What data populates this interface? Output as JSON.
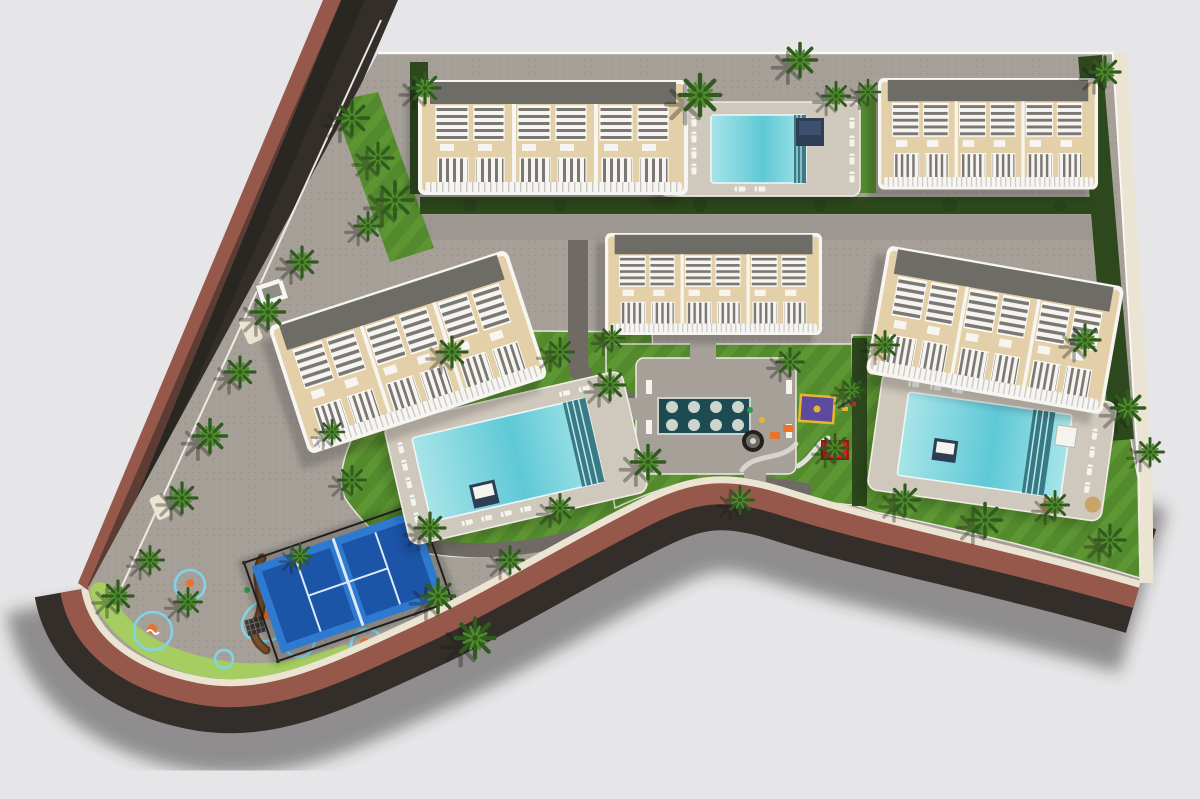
{
  "scene": {
    "kind": "aerial-site-plan-3d-render",
    "description": "Top-down architectural rendering of a residential resort complex with five apartment blocks, three swimming pools, a reflecting pond plaza, playground, splash pad, padel court, palm trees, perimeter road and paths",
    "background_label": "empty light-gray ground"
  },
  "colors": {
    "background": "#e6e6e8",
    "asphalt": "#332e29",
    "asphalt_shadow": "#262320",
    "brick": "#96584b",
    "sidewalk_cream": "#ece4d2",
    "paving": "#a6a099",
    "paving_dot": "#8a847c",
    "path_dark": "#6f6a64",
    "lawn": "#538a2d",
    "lawn_stripe": "#6da53c",
    "lawn_light": "#a5cd62",
    "hedge": "#2c481c",
    "palm_green": "#2f5c1e",
    "palm_light": "#4f8a2b",
    "roof_beige": "#e4d0a8",
    "roof_gray": "#6e6c67",
    "building_white": "#f6f5f2",
    "stripe_gray": "#7b7873",
    "pool_turquoise": "#5ec9d6",
    "pool_light": "#a7e4e8",
    "pool_steps": "#2e6f7a",
    "pond_teal": "#1e4a52",
    "pond_disc": "#cdd6cd",
    "deck": "#cfc8bc",
    "padel_blue": "#2e7ad0",
    "padel_dark": "#1c55a8",
    "padel_line": "#dce9f8",
    "cage_black": "#1f1f1f",
    "splash_blue": "#2f86c8",
    "splash_rim": "#7fd4e8",
    "accent_orange": "#e8742c",
    "accent_red": "#c6281e",
    "accent_yellow": "#e8b62a",
    "accent_purple": "#5b4a9e",
    "daybed_navy": "#2e3e55",
    "wood_brown": "#5f3d22",
    "white": "#f5f3ee"
  },
  "elements": [
    {
      "name": "access-road",
      "color_ref": "asphalt"
    },
    {
      "name": "road-brick-verge",
      "color_ref": "brick"
    },
    {
      "name": "perimeter-promenade",
      "color_ref": "sidewalk_cream"
    },
    {
      "name": "apartment-block-a",
      "count_units_visible": 3
    },
    {
      "name": "apartment-block-b",
      "count_units_visible": 3
    },
    {
      "name": "apartment-block-c",
      "count_units_visible": 3
    },
    {
      "name": "apartment-block-d",
      "count_units_visible": 3
    },
    {
      "name": "apartment-block-e",
      "count_units_visible": 3
    },
    {
      "name": "north-pool",
      "color_ref": "pool_turquoise"
    },
    {
      "name": "west-pool",
      "color_ref": "pool_turquoise"
    },
    {
      "name": "east-pool",
      "color_ref": "pool_turquoise"
    },
    {
      "name": "reflecting-pond",
      "color_ref": "pond_teal",
      "stepping_discs": 8
    },
    {
      "name": "playground",
      "color_refs": [
        "accent_purple",
        "accent_red",
        "accent_yellow",
        "accent_orange"
      ]
    },
    {
      "name": "splash-pad",
      "color_ref": "splash_blue"
    },
    {
      "name": "padel-court",
      "color_ref": "padel_blue"
    },
    {
      "name": "palm-trees",
      "color_ref": "palm_green"
    },
    {
      "name": "lawns",
      "color_ref": "lawn"
    },
    {
      "name": "hedges",
      "color_ref": "hedge"
    }
  ]
}
